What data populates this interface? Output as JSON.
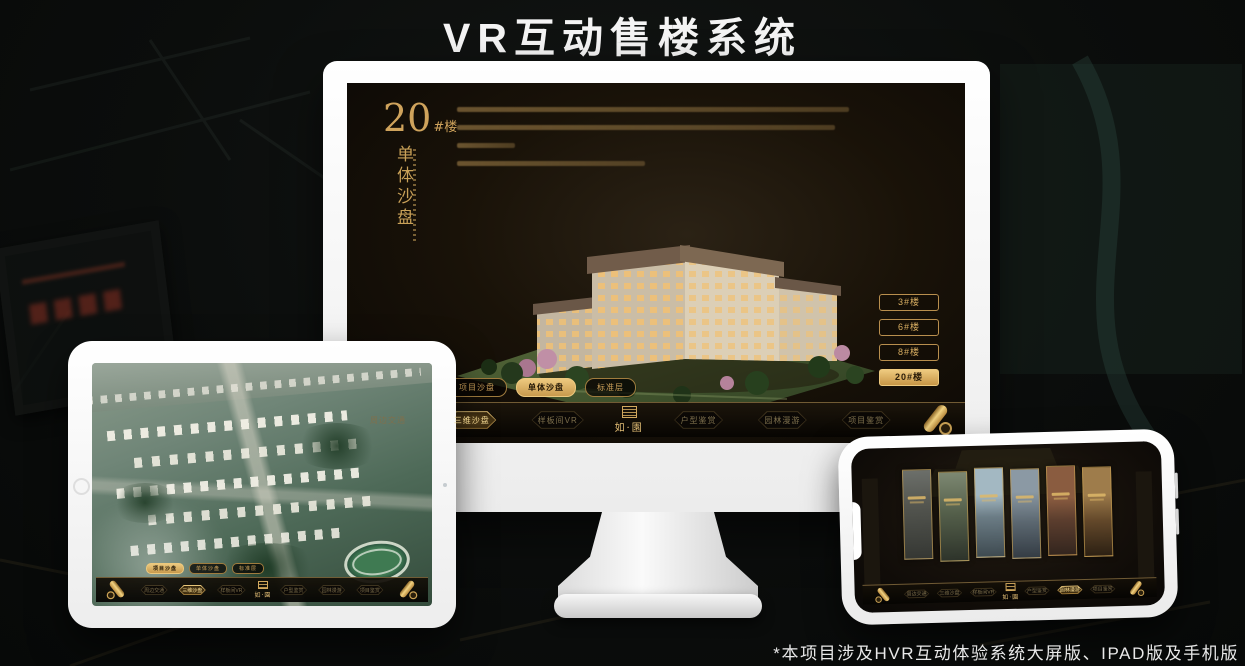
{
  "page": {
    "title": "VR互动售楼系统",
    "footnote": "*本项目涉及HVR互动体验系统大屏版、IPAD版及手机版"
  },
  "theme": {
    "gold": "#c9a25e",
    "gold_bright": "#eeca7f",
    "screen_bg": "#19120b",
    "active_text_dark": "#2a1c08"
  },
  "monitor": {
    "floor_number": "20",
    "floor_suffix": "#楼",
    "subtitle_vertical": "单体沙盘",
    "floor_buttons": [
      {
        "label": "3#楼",
        "active": false
      },
      {
        "label": "6#楼",
        "active": false
      },
      {
        "label": "8#楼",
        "active": false
      },
      {
        "label": "20#楼",
        "active": true
      }
    ]
  },
  "sub_tabs": {
    "items": [
      {
        "label": "项目沙盘"
      },
      {
        "label": "单体沙盘"
      },
      {
        "label": "标准层"
      }
    ],
    "monitor_active": "单体沙盘",
    "tablet_active": "项目沙盘"
  },
  "nav": {
    "logo": "如·園",
    "items": [
      {
        "label": "周边交通"
      },
      {
        "label": "三维沙盘"
      },
      {
        "label": "样板间VR"
      },
      {
        "label": "户型鉴赏"
      },
      {
        "label": "园林漫游"
      },
      {
        "label": "项目鉴赏"
      }
    ],
    "monitor_active": "三维沙盘",
    "tablet_active": "三维沙盘",
    "phone_active": "园林漫游"
  }
}
